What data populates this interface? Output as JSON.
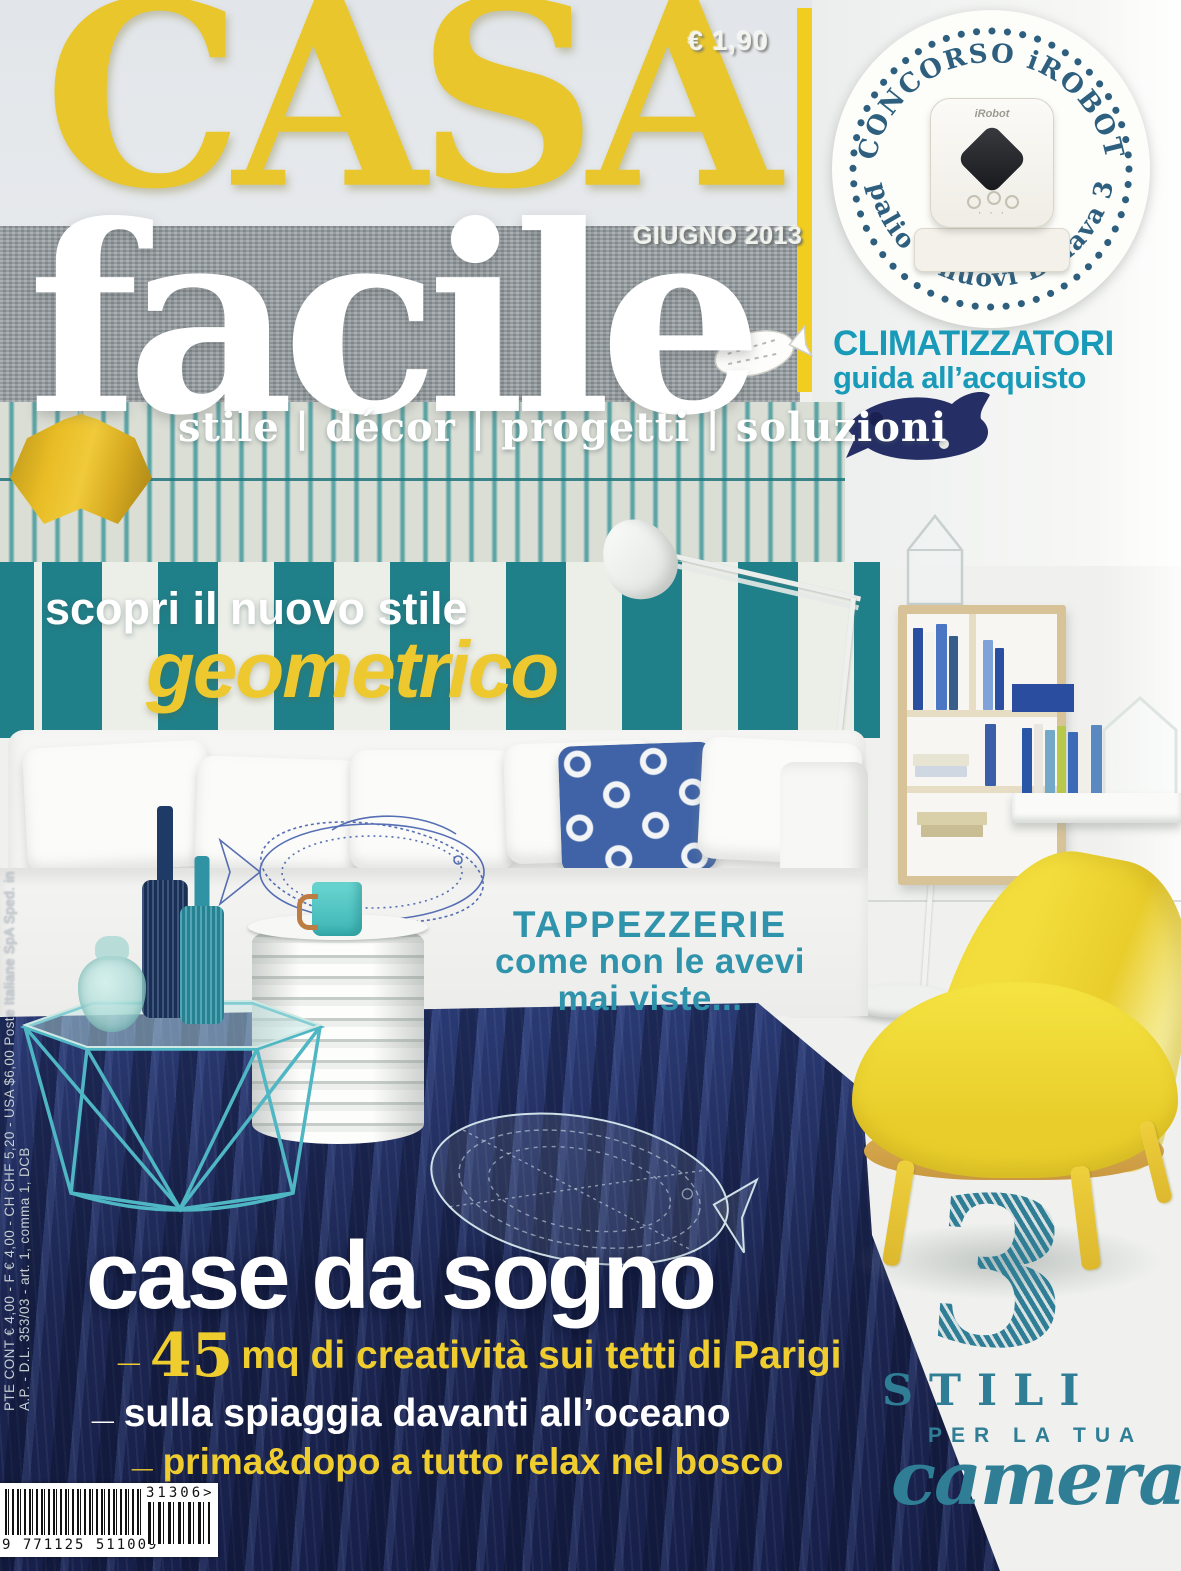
{
  "masthead": {
    "price": "€ 1,90",
    "issue_date": "GIUGNO 2013",
    "title": "CASA",
    "subtitle": "facile",
    "tagline": "stile | décor | progetti | soluzioni"
  },
  "contest_badge": {
    "arc_top": "CONCORSO iROBOT",
    "arc_bottom": "in palio 5 nuovi Braava 320",
    "product_brand": "iRobot",
    "product_dots": "· · ·"
  },
  "right_column": {
    "headline": "CLIMATIZZATORI",
    "subheadline": "guida all’acquisto"
  },
  "geometrico_block": {
    "kicker": "scopri il nuovo stile",
    "title": "geometrico"
  },
  "tappezzerie_block": {
    "line1": "TAPPEZZERIE",
    "line2": "come non le avevi",
    "line3": "mai viste..."
  },
  "case_block": {
    "title": "case da sogno",
    "bullet1_dash": "_",
    "bullet1_lead": "45",
    "bullet1_text": "mq di creatività sui tetti di Parigi",
    "bullet2_dash": "_",
    "bullet2_text": "sulla spiaggia davanti all’oceano",
    "bullet3_dash": "_",
    "bullet3_text": "prima&dopo a tutto relax nel bosco"
  },
  "camera_block": {
    "number": "3",
    "line1": "STILI",
    "line2": "PER LA TUA",
    "line3": "camera"
  },
  "barcode": {
    "addon": "31306>",
    "digits": "9 771125 511009"
  },
  "spine_text": "PTE CONT € 4,00 - F € 4,00 - CH CHF 5,20 - USA $6,00    Poste Italiane SpA Sped. in A.P. - D.L. 353/03 - art. 1, comma 1, DCB",
  "colors": {
    "masthead_yellow": "#e9c62c",
    "teal_stripe": "#20808a",
    "headline_teal": "#199ab8",
    "tappezzerie_teal": "#2f93ac",
    "camera_teal": "#2f7e95",
    "rug_navy": "#1d2a5e",
    "badge_navy": "#2e5f7e",
    "chair_yellow": "#eed735"
  }
}
